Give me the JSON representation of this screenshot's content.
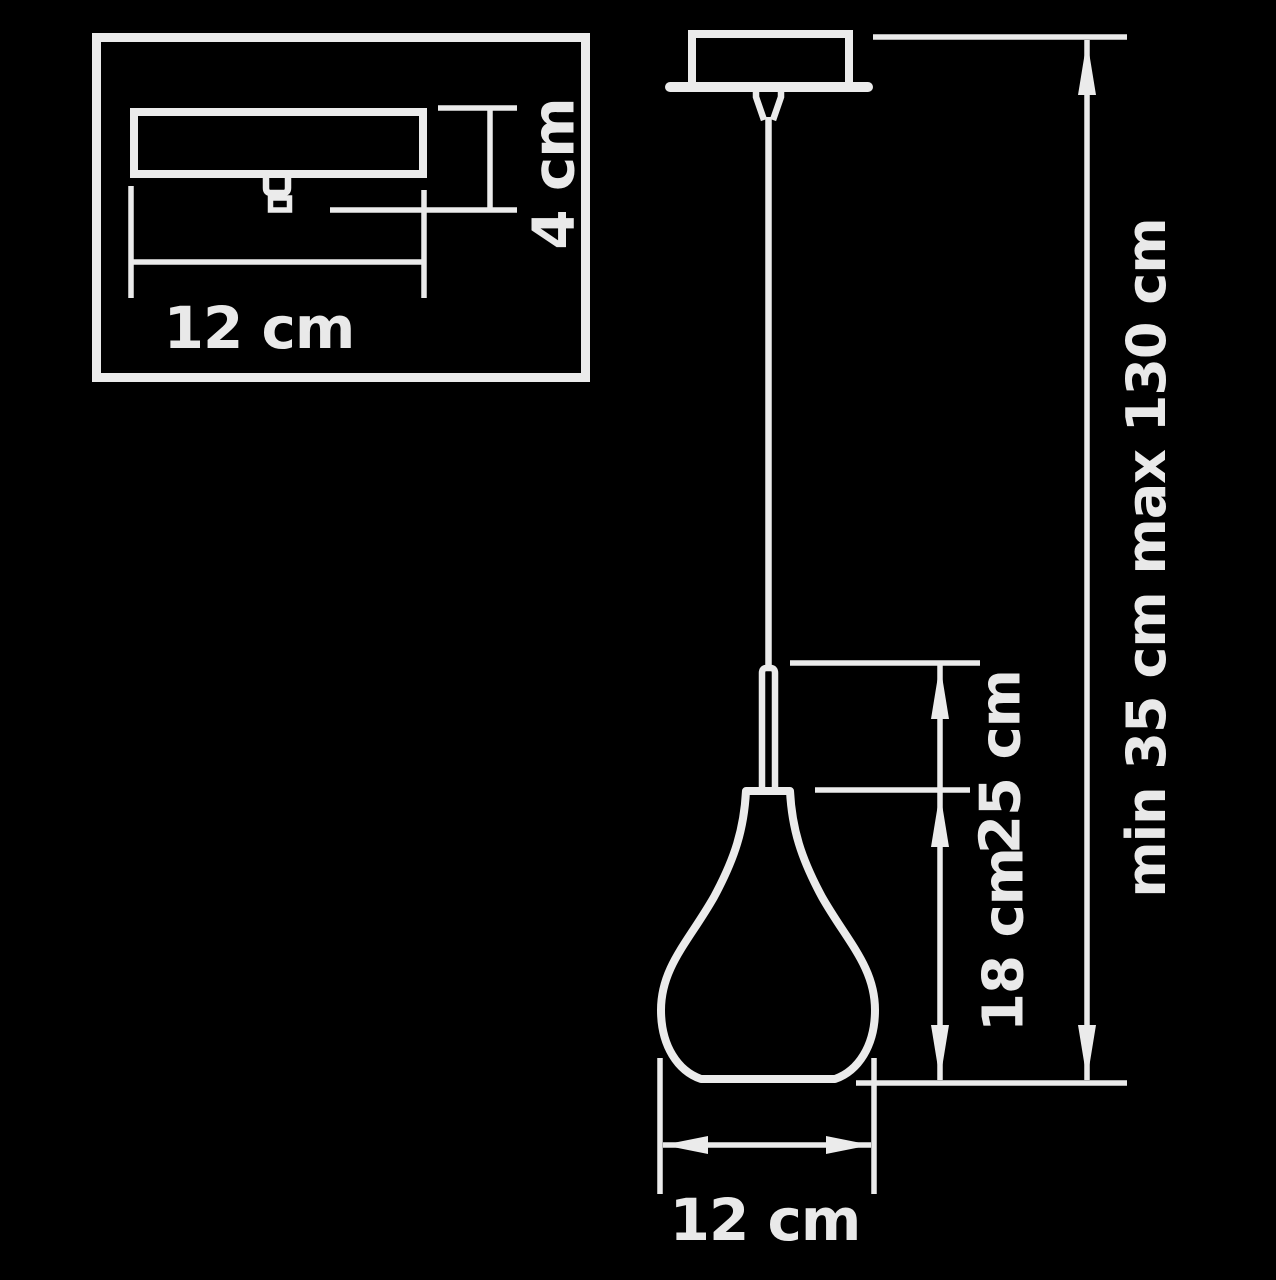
{
  "diagram": {
    "kind": "pendant-lamp-dimension-drawing",
    "colors": {
      "background": "#000000",
      "line": "#ebebeb",
      "text": "#e9e9e9"
    },
    "labels": {
      "inset_width": "12 cm",
      "inset_height": "4 cm",
      "shade_width": "12 cm",
      "body_height": "25 cm",
      "shade_height": "18 cm",
      "suspension": "min 35 cm max 130 cm"
    }
  }
}
